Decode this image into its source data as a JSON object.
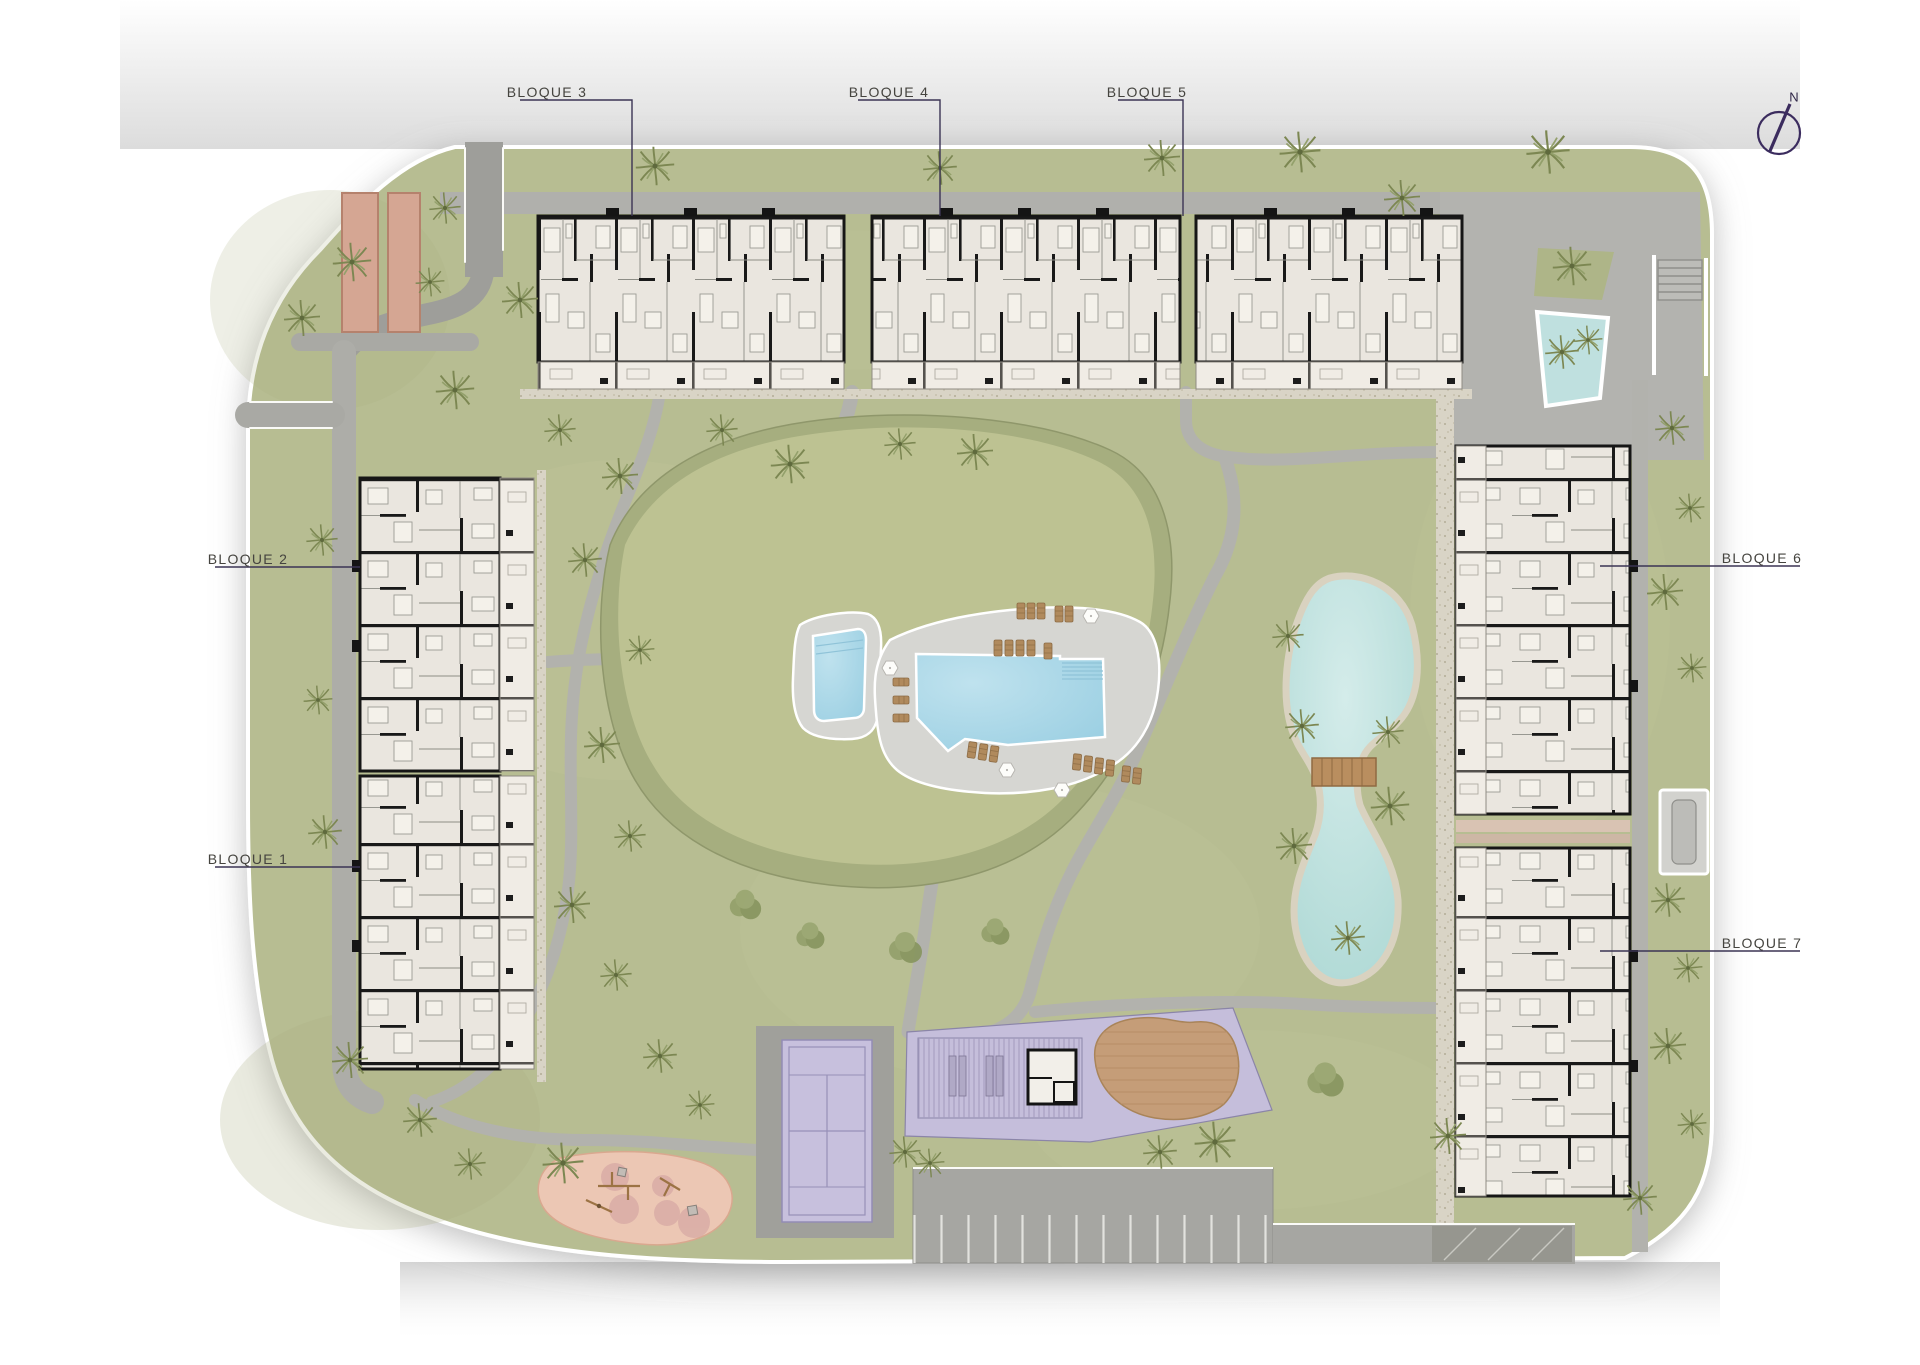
{
  "plan": {
    "blocks": [
      {
        "label": "BLOQUE 1"
      },
      {
        "label": "BLOQUE 2"
      },
      {
        "label": "BLOQUE 3"
      },
      {
        "label": "BLOQUE 4"
      },
      {
        "label": "BLOQUE 5"
      },
      {
        "label": "BLOQUE 6"
      },
      {
        "label": "BLOQUE 7"
      }
    ],
    "compass": {
      "north": "N"
    }
  },
  "palette": {
    "grass": "#b7bd92",
    "mound_top": "#bdc292",
    "mound_slope": "#a6ae7f",
    "road": "#adada8",
    "path": "#b2b2ad",
    "gravel": "#d9d4c6",
    "pool_deck": "#d6d6d2",
    "pool_water": "#a7d7e7",
    "lake_water": "#bfe2df",
    "lake_shore": "#d9d2c0",
    "building_floor": "#eae6df",
    "building_wall": "#191919",
    "terrace": "#f0ece5",
    "sports_court_purple": "#c7c0dd",
    "zone_purple": "#c5bedb",
    "wood_deck_brown": "#c59d78",
    "bridge_brown": "#b98e5f",
    "playground_pink": "#ecc7b4",
    "petanque_clay": "#d5a693",
    "label_text": "#45443f",
    "leader_line": "#3b3454",
    "compass_purple": "#3b2c5e"
  },
  "icons": {
    "compass": "north-arrow-icon"
  }
}
